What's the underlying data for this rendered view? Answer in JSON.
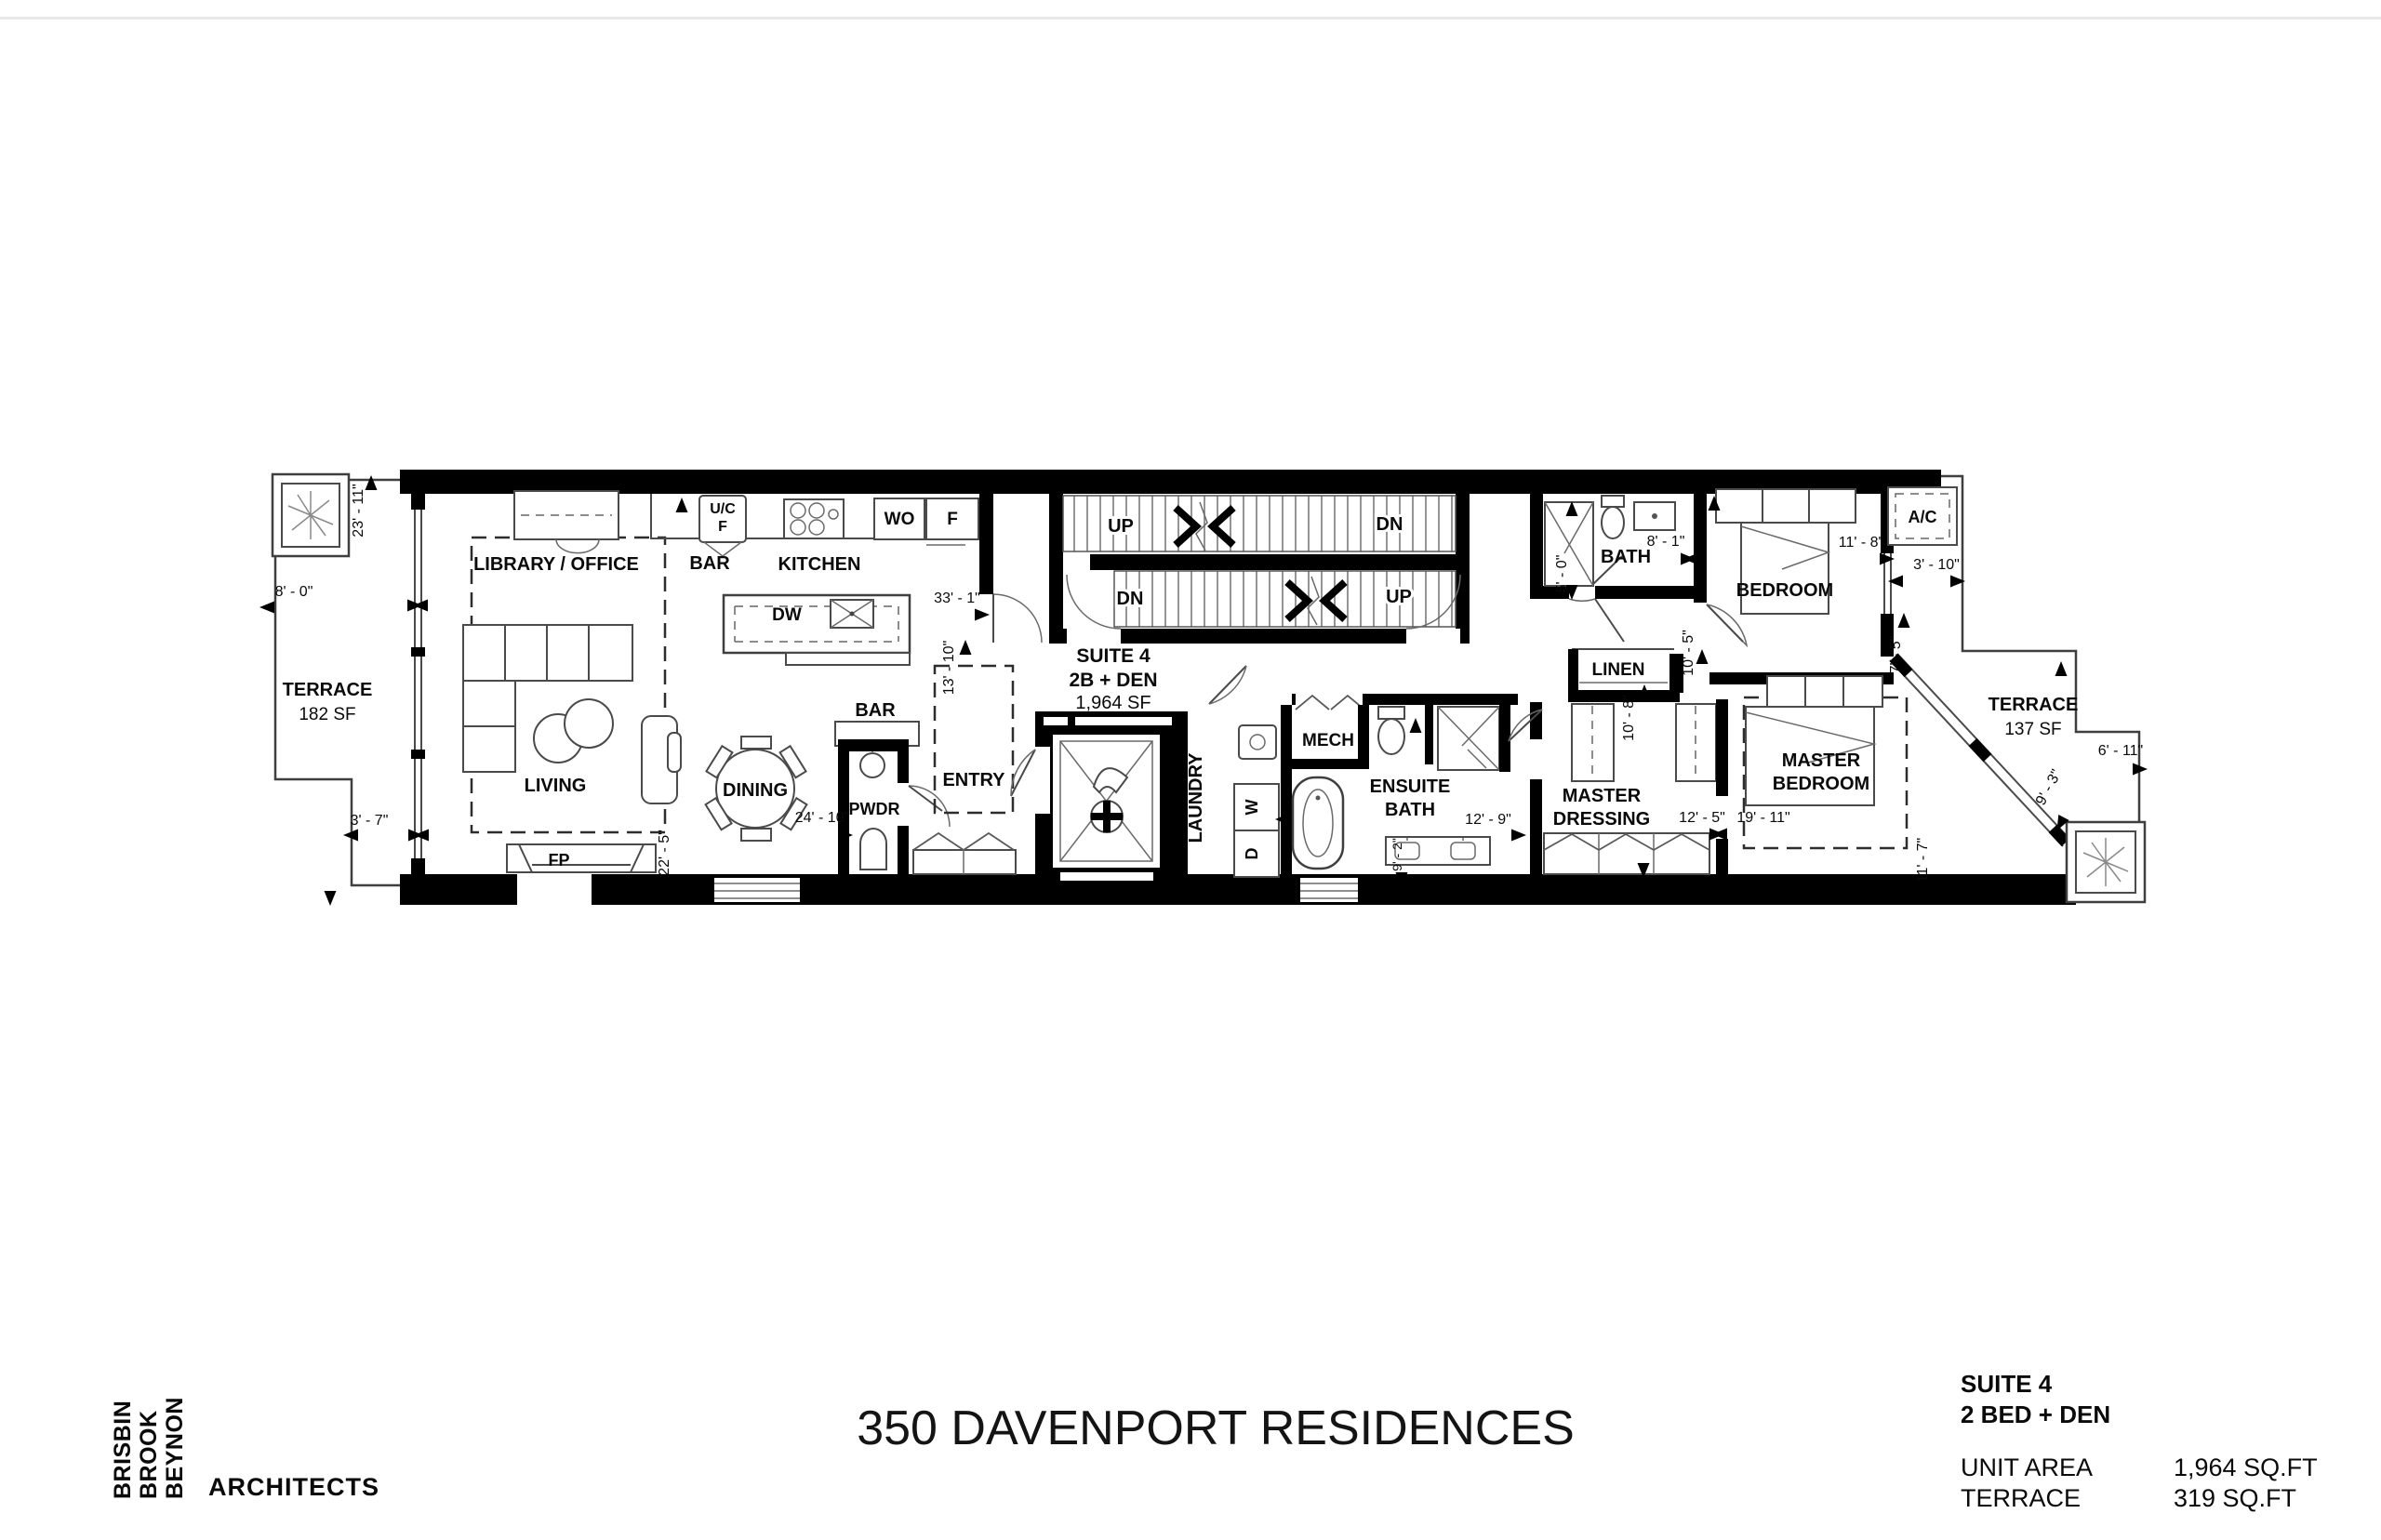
{
  "plan": {
    "terrace_left": {
      "name": "TERRACE",
      "area": "182 SF"
    },
    "library_office": "LIBRARY / OFFICE",
    "living": "LIVING",
    "fireplace": "FP",
    "bar_kitchen": "BAR",
    "kitchen": "KITCHEN",
    "uc_line1": "U/C",
    "uc_line2": "F",
    "wall_oven": "WO",
    "fridge": "F",
    "dishwasher": "DW",
    "dining": "DINING",
    "bar_dining": "BAR",
    "powder": "PWDR",
    "entry": "ENTRY",
    "suite": {
      "line1": "SUITE 4",
      "line2": "2B + DEN",
      "line3": "1,964 SF"
    },
    "stairs": {
      "up_left": "UP",
      "dn_right": "DN",
      "dn_left": "DN",
      "up_right": "UP"
    },
    "laundry": "LAUNDRY",
    "washer": "W",
    "dryer": "D",
    "mech": "MECH",
    "ensuite_line1": "ENSUITE",
    "ensuite_line2": "BATH",
    "bath": "BATH",
    "linen": "LINEN",
    "bedroom": "BEDROOM",
    "master_dressing_line1": "MASTER",
    "master_dressing_line2": "DRESSING",
    "master_bedroom_line1": "MASTER",
    "master_bedroom_line2": "BEDROOM",
    "ac": "A/C",
    "terrace_right": {
      "name": "TERRACE",
      "area": "137 SF"
    },
    "dims": {
      "d23_11": "23' - 11\"",
      "d8_0": "8' - 0\"",
      "d3_7": "3' - 7\"",
      "d22_5": "22' - 5\"",
      "d33_1": "33' - 1\"",
      "d13_10": "13' - 10\"",
      "d24_10": "24' - 10\"",
      "d12_9": "12' - 9\"",
      "d9_2": "9' - 2\"",
      "d8_1": "8' - 1\"",
      "d5_0": "5' - 0\"",
      "d11_8": "11' - 8\"",
      "d10_5": "10' - 5\"",
      "d3_10": "3' - 10\"",
      "d7_5": "7' - 5\"",
      "d10_8": "10' - 8\"",
      "d12_5": "12' - 5\"",
      "d19_11": "19' - 11\"",
      "d11_7": "11' - 7\"",
      "d9_3": "9' - 3\"",
      "d6_11": "6' - 11\""
    }
  },
  "footer": {
    "title": "350 DAVENPORT RESIDENCES",
    "logo": {
      "line1": "BRISBIN",
      "line2": "BROOK",
      "line3": "BEYNON",
      "word": "ARCHITECTS",
      "gray": "#8a9194",
      "orange": "#f2a73d"
    },
    "info": {
      "suite": "SUITE 4",
      "type": "2 BED + DEN",
      "rows": [
        {
          "label": "UNIT AREA",
          "value": "1,964 SQ.FT"
        },
        {
          "label": "TERRACE",
          "value": "319 SQ.FT"
        }
      ]
    }
  }
}
